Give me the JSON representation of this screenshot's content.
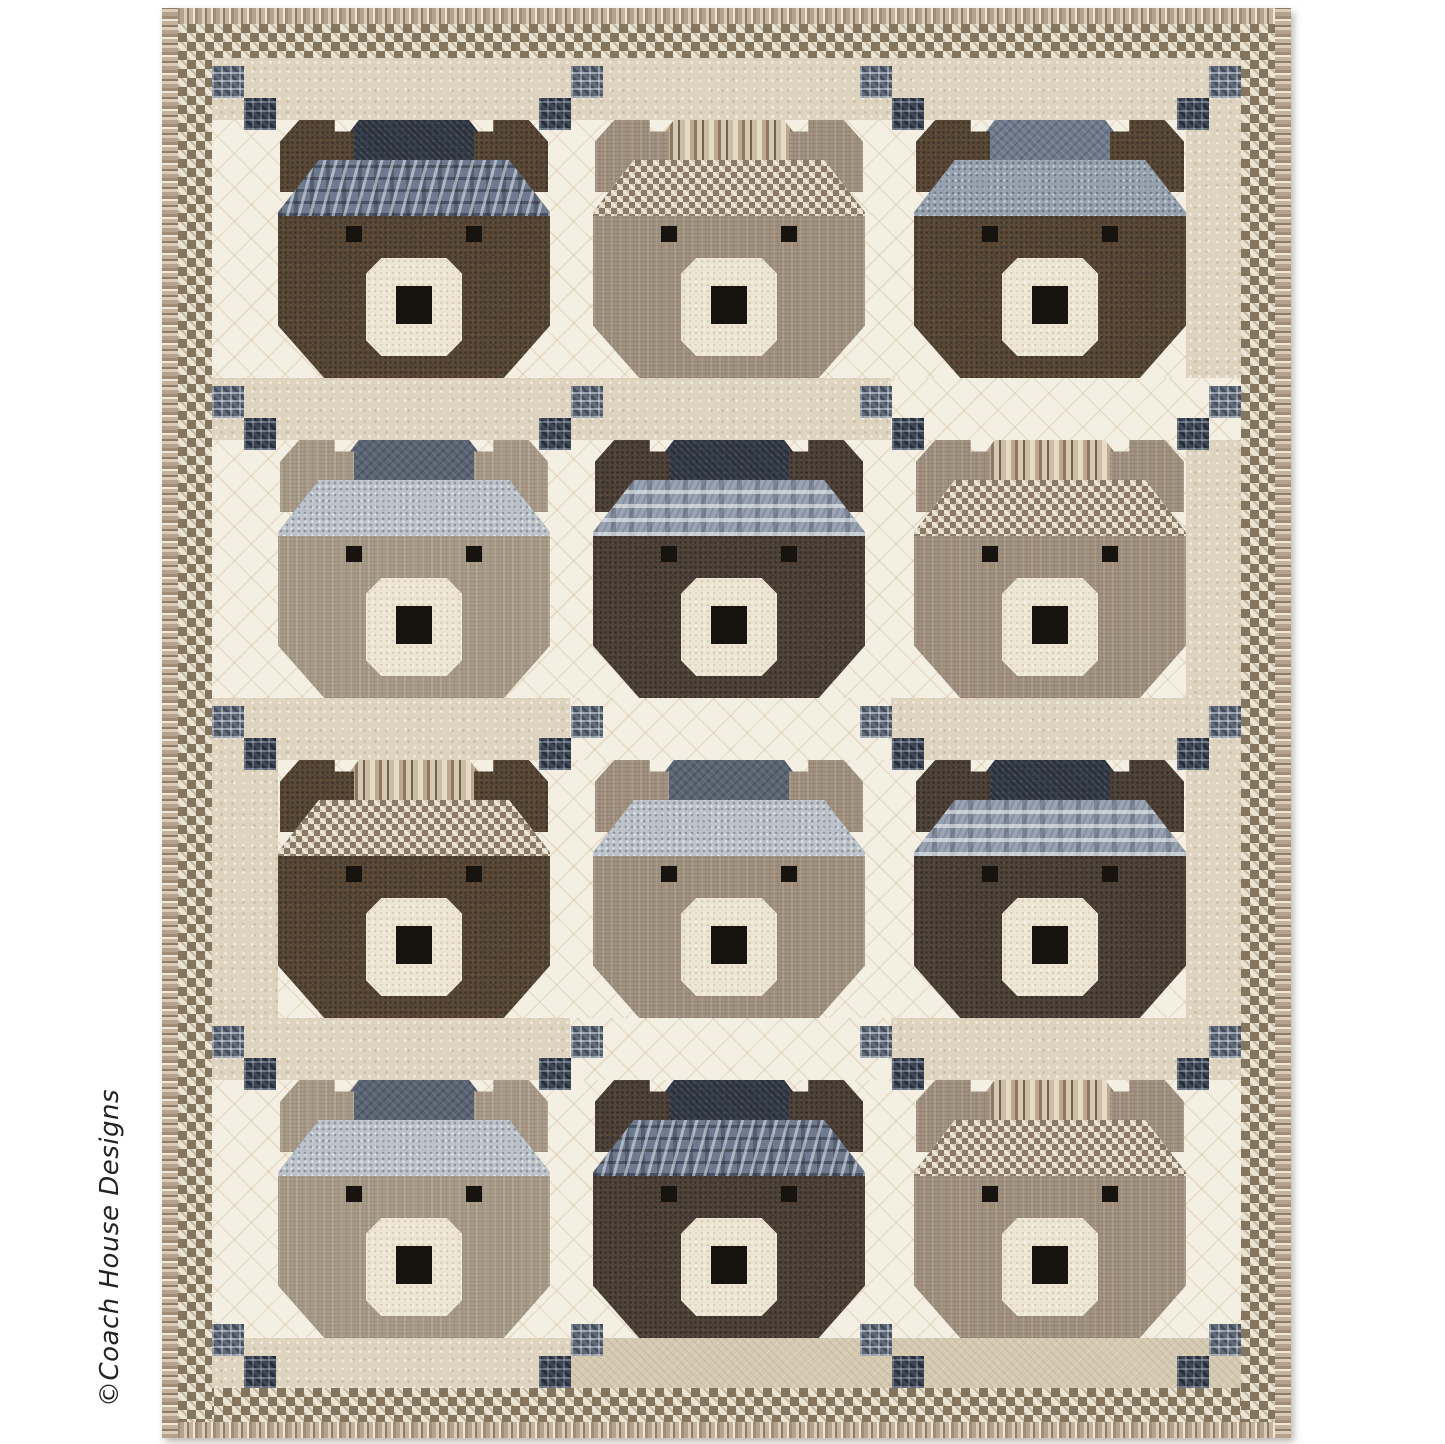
{
  "credit": {
    "text": "©Coach House Designs"
  },
  "palette": {
    "page_bg": "#ffffff",
    "background_cream": "#f4efe3",
    "background_beige": "#ddd3bf",
    "background_tan": "#d5c9b2",
    "houndstooth_brown": "#84755f",
    "houndstooth_cream": "#ece4d2",
    "fur_dark_brown": "#584838",
    "fur_dark_brown_2": "#4e4339",
    "fur_taupe": "#a09181",
    "fur_taupe_light": "#a89a89",
    "hat_navy": "#39404d",
    "hat_slate": "#596372",
    "hat_bluegray": "#6e7a8b",
    "cornerstone_plaid_medium": "#5f6977",
    "cornerstone_plaid_dark": "#3d4654",
    "muzzle_cream": "#ece5d3",
    "eye_nose_black": "#17130f"
  },
  "quilt": {
    "rows": 4,
    "cols": 3,
    "border_outer": "striped-binding",
    "border_inner": "houndstooth",
    "bears": [
      {
        "fur": "dark-brown",
        "band": "navy-plaid",
        "crown": "navy"
      },
      {
        "fur": "taupe",
        "band": "houndstooth",
        "crown": "stripes"
      },
      {
        "fur": "dark-brown",
        "band": "bluegray-dots",
        "crown": "bluegray"
      },
      {
        "fur": "taupe-light",
        "band": "gray-dots",
        "crown": "slate"
      },
      {
        "fur": "dark-brown-2",
        "band": "bluegray-plaid",
        "crown": "navy"
      },
      {
        "fur": "taupe",
        "band": "houndstooth",
        "crown": "stripes"
      },
      {
        "fur": "dark-brown",
        "band": "houndstooth",
        "crown": "stripes"
      },
      {
        "fur": "taupe",
        "band": "gray-dots",
        "crown": "slate"
      },
      {
        "fur": "dark-brown-2",
        "band": "bluegray-plaid",
        "crown": "navy"
      },
      {
        "fur": "taupe-light",
        "band": "gray-dots",
        "crown": "slate"
      },
      {
        "fur": "dark-brown-2",
        "band": "navy-plaid",
        "crown": "navy"
      },
      {
        "fur": "taupe",
        "band": "houndstooth",
        "crown": "stripes"
      }
    ],
    "sashing_bands": [
      [
        "beige",
        "beige",
        "beige"
      ],
      [
        "beige",
        "beige",
        "cream"
      ],
      [
        "beige",
        "cream",
        "beige"
      ],
      [
        "beige",
        "cream",
        "beige"
      ],
      [
        "beige",
        "tan",
        "tan"
      ]
    ],
    "side_patches": [
      {
        "side": "right",
        "rows": [
          0,
          1,
          2
        ],
        "fabric": "beige"
      },
      {
        "side": "left",
        "rows": [
          2
        ],
        "fabric": "beige"
      }
    ]
  }
}
